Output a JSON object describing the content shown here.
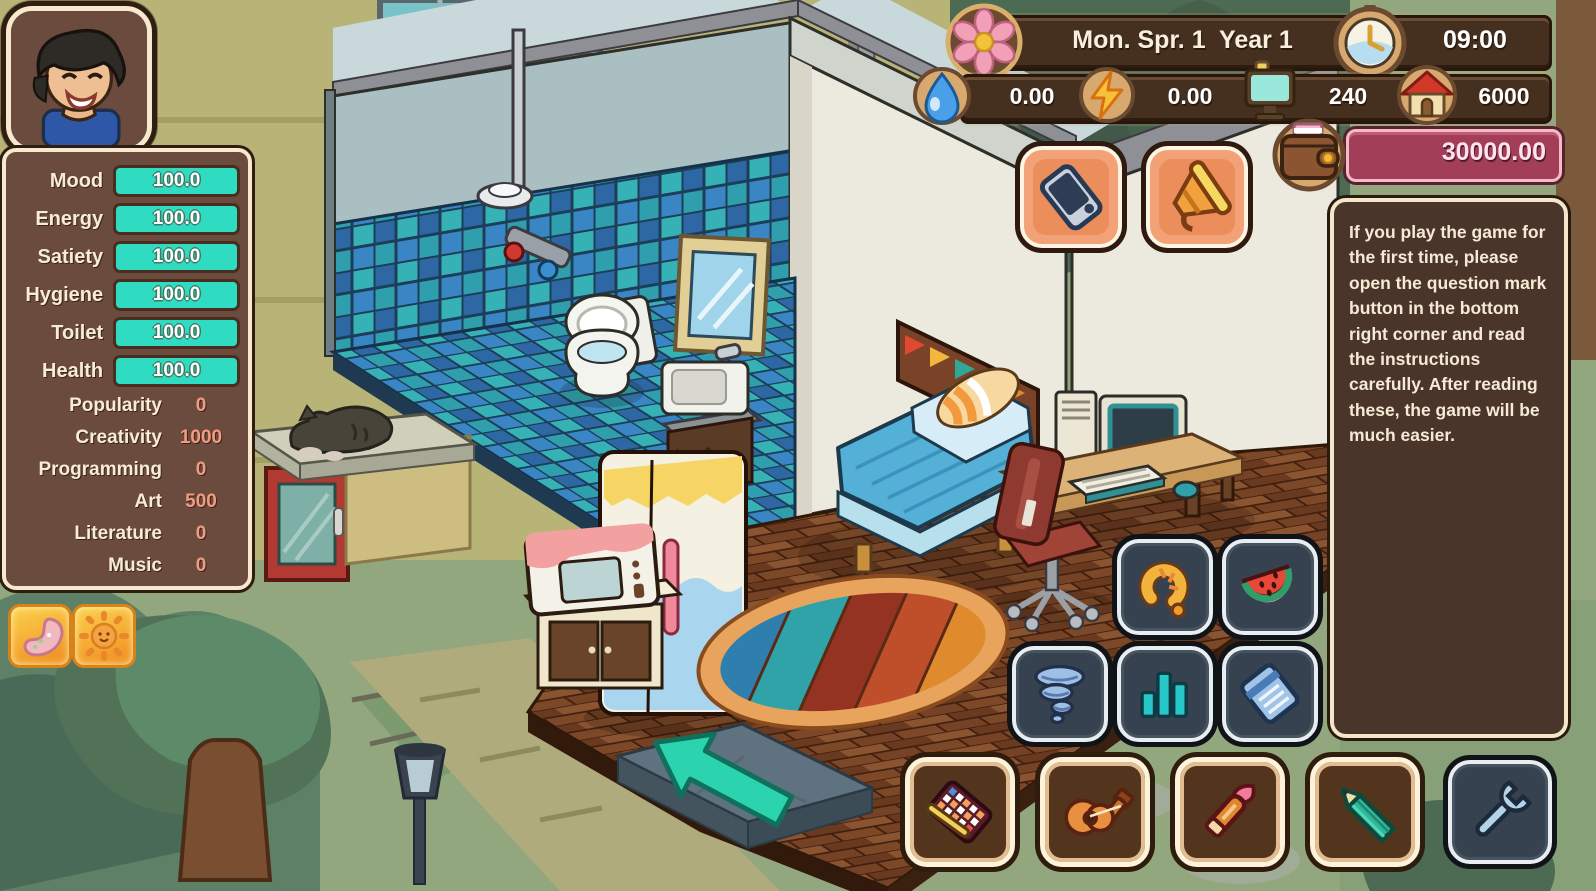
{
  "hud": {
    "date": "Mon. Spr. 1  Year 1",
    "time": "09:00",
    "bills": {
      "water": "0.00",
      "electricity": "0.00",
      "computer": "240",
      "house": "6000"
    },
    "money": "30000.00"
  },
  "stats": {
    "needs": [
      {
        "label": "Mood",
        "value": "100.0"
      },
      {
        "label": "Energy",
        "value": "100.0"
      },
      {
        "label": "Satiety",
        "value": "100.0"
      },
      {
        "label": "Hygiene",
        "value": "100.0"
      },
      {
        "label": "Toilet",
        "value": "100.0"
      },
      {
        "label": "Health",
        "value": "100.0"
      }
    ],
    "skills": [
      {
        "label": "Popularity",
        "value": "0"
      },
      {
        "label": "Creativity",
        "value": "1000"
      },
      {
        "label": "Programming",
        "value": "0"
      },
      {
        "label": "Art",
        "value": "500"
      },
      {
        "label": "Literature",
        "value": "0"
      },
      {
        "label": "Music",
        "value": "0"
      }
    ]
  },
  "buffs": [
    {
      "name": "stomach-buff"
    },
    {
      "name": "sun-buff"
    }
  ],
  "help_panel": {
    "text": "If you play the game for the first time, please open the question mark button in the bottom right corner and read the instructions carefully. After reading these, the game will be much easier."
  },
  "toolbar": {
    "buttons": [
      "phone",
      "megaphone",
      "hook",
      "watermelon",
      "tornado",
      "statistics",
      "notebook",
      "keyboard-writing",
      "guitar",
      "painting",
      "pencil",
      "wrench"
    ]
  },
  "icons": [
    "season-flower-icon",
    "clock-icon",
    "water-drop-icon",
    "lightning-icon",
    "computer-bill-icon",
    "house-rent-icon",
    "wallet-icon",
    "stomach-buff-icon",
    "sun-buff-icon",
    "exit-arrow"
  ],
  "colors": {
    "accent_teal": "#2fdcc1",
    "panel_brown": "#6a4b3e",
    "panel_border": "#f6e9ce",
    "hud_bar_brown": "#45301f",
    "money_bar": "#a23e57",
    "skill_value_salmon": "#f49a82",
    "button_navy": "#36424f",
    "button_salmon": "#f2a276",
    "button_brown": "#53351d",
    "exit_arrow_teal": "#2bd4ae"
  }
}
